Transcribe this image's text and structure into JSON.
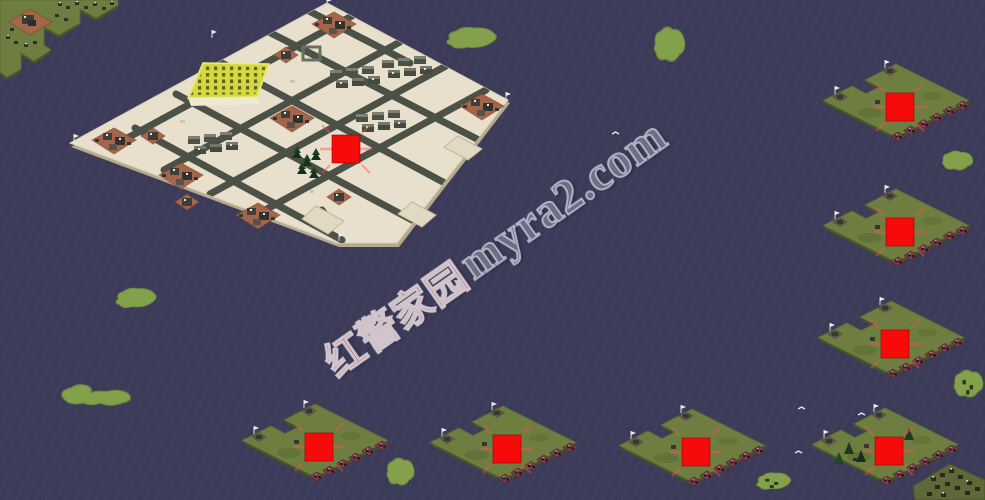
{
  "title": "Red Alert 2 naval map preview",
  "watermark": {
    "cjk": "红警家园",
    "latin": "myra2.com"
  },
  "colors": {
    "water": "#3c3c5a",
    "sand": "#e8e0cd",
    "sand_wall": "#b6aa8d",
    "road": "#4c5148",
    "green": "#6e7e40",
    "green_wall": "#45522a",
    "blob": "#83a04b",
    "marker": "#f60a0a",
    "halo": "rgba(255,80,80,0.45)",
    "brown": "#a4664a",
    "field": "#d6d83f"
  },
  "start_markers": [
    {
      "id": "main-island",
      "cx": 346,
      "cy": 149
    },
    {
      "id": "right-1",
      "cx": 900,
      "cy": 107
    },
    {
      "id": "right-2",
      "cx": 900,
      "cy": 232
    },
    {
      "id": "right-3",
      "cx": 895,
      "cy": 344
    },
    {
      "id": "bottom-1",
      "cx": 319,
      "cy": 447
    },
    {
      "id": "bottom-2",
      "cx": 507,
      "cy": 449
    },
    {
      "id": "bottom-3",
      "cx": 696,
      "cy": 452
    },
    {
      "id": "bottom-4",
      "cx": 889,
      "cy": 451
    }
  ],
  "green_islands": [
    {
      "id": "right-1",
      "x": 820,
      "y": 64
    },
    {
      "id": "right-2",
      "x": 820,
      "y": 189
    },
    {
      "id": "right-3",
      "x": 815,
      "y": 301
    },
    {
      "id": "bottom-1",
      "x": 239,
      "y": 404
    },
    {
      "id": "bottom-2",
      "x": 427,
      "y": 406
    },
    {
      "id": "bottom-3",
      "x": 616,
      "y": 409
    },
    {
      "id": "bottom-4",
      "x": 809,
      "y": 408,
      "extra": true
    }
  ],
  "blob_islands": [
    {
      "x": 437,
      "y": 24,
      "w": 64,
      "h": 30,
      "v": 0
    },
    {
      "x": 650,
      "y": 22,
      "w": 38,
      "h": 48,
      "v": 1
    },
    {
      "x": 938,
      "y": 148,
      "w": 38,
      "h": 27,
      "v": 1
    },
    {
      "x": 108,
      "y": 285,
      "w": 52,
      "h": 28,
      "v": 0
    },
    {
      "x": 58,
      "y": 378,
      "w": 78,
      "h": 34,
      "v": 2
    },
    {
      "x": 383,
      "y": 454,
      "w": 34,
      "h": 38,
      "v": 1
    },
    {
      "x": 750,
      "y": 470,
      "w": 44,
      "h": 24,
      "v": 0,
      "specks": true
    },
    {
      "x": 950,
      "y": 366,
      "w": 36,
      "h": 38,
      "v": 1,
      "specks": true
    }
  ],
  "birds": [
    {
      "x": 798,
      "y": 406
    },
    {
      "x": 858,
      "y": 412
    },
    {
      "x": 795,
      "y": 450
    },
    {
      "x": 612,
      "y": 131
    }
  ]
}
